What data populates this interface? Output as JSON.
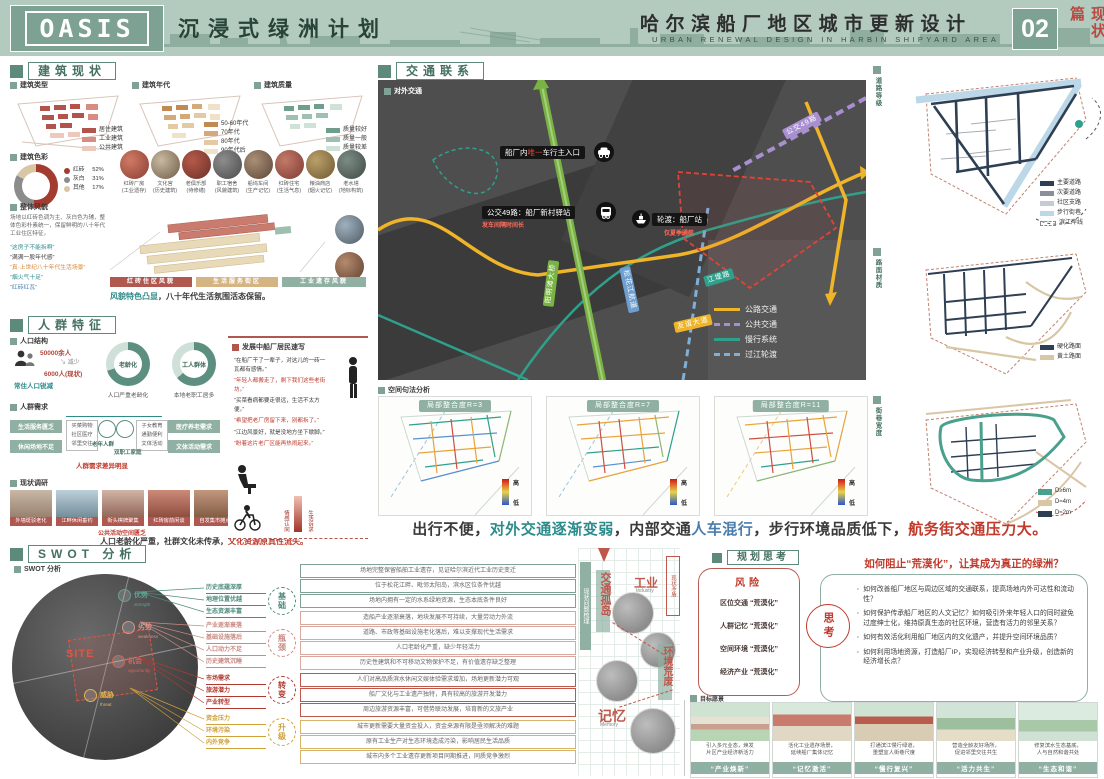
{
  "header": {
    "logo": "OASIS",
    "subtitle": "沉浸式绿洲计划",
    "project_cn": "哈尔滨船厂地区城市更新设计",
    "project_en": "URBAN RENEWAL DESIGN IN HARBIN SHIPYARD AREA",
    "page_no": "02",
    "page_tag": "现状篇"
  },
  "building": {
    "title": "建筑现状",
    "maps": [
      {
        "label": "建筑类型",
        "legend": [
          "居住建筑",
          "工业建筑",
          "公共建筑"
        ]
      },
      {
        "label": "建筑年代",
        "legend": [
          "50-60年代",
          "70年代",
          "80年代",
          "90年代后"
        ]
      },
      {
        "label": "建筑质量",
        "legend": [
          "质量较好",
          "质量一般",
          "质量较差"
        ]
      }
    ],
    "color": {
      "label": "建筑色彩",
      "slices": [
        {
          "name": "红砖",
          "pct": "52%"
        },
        {
          "name": "灰白",
          "pct": "31%"
        },
        {
          "name": "其他",
          "pct": "17%"
        }
      ],
      "note": "场地以红砖色调为主、灰白色为辅，整体色彩朴素统一，保留鲜明的八十年代工业住区特征。"
    },
    "photos": [
      {
        "name": "红砖厂房",
        "note": "(工业遗存)"
      },
      {
        "name": "文化宫",
        "note": "(历史建筑)"
      },
      {
        "name": "老俱乐部",
        "note": "(待修缮)"
      },
      {
        "name": "职工宿舍",
        "note": "(风貌建筑)"
      },
      {
        "name": "船坞车间",
        "note": "(生产记忆)"
      },
      {
        "name": "红砖住宅",
        "note": "(生活气息)"
      },
      {
        "name": "粮油商店",
        "note": "(烟火记忆)"
      },
      {
        "name": "老水塔",
        "note": "(地标构筑)"
      }
    ],
    "axon_tag": "整体风貌",
    "quotes": [
      {
        "t": "“这房子不能拆啊”"
      },
      {
        "t": "“满满一股年代感”"
      },
      {
        "t": "“真·上世纪八十年代生活场景”"
      },
      {
        "t": "“烟火气十足”"
      },
      {
        "t": "“红砖红瓦”"
      }
    ],
    "zones": [
      "红砖住区风貌",
      "生活服务街区",
      "工业遗存风貌"
    ],
    "summary": [
      {
        "t": "风貌特色凸显"
      },
      {
        "t": "，八十年代生活氛围活态保留。"
      }
    ]
  },
  "population": {
    "title": "人群特征",
    "struct": {
      "label": "人口结构",
      "from": "50000余人",
      "trend": "减少",
      "to": "6000人(现状)",
      "cap": "常住人口锐减",
      "donuts": [
        {
          "center": "老龄化",
          "cap": "人口严重老龄化"
        },
        {
          "center": "工人群体",
          "cap": "本地老职工居多"
        }
      ]
    },
    "needs": {
      "label": "人群需求",
      "left": [
        "生活服务匮乏",
        "休闲场地不足"
      ],
      "right": [
        "医疗养老需求",
        "文体活动需求"
      ],
      "g1": "老年人群",
      "g2": "双职工家庭",
      "list1": [
        "买菜购物",
        "社区医疗",
        "邻里交往"
      ],
      "list2": [
        "子女教育",
        "通勤便利",
        "文体活动"
      ],
      "cap": "人群需求差异明显"
    },
    "voice": {
      "label": "发展中船厂居民速写",
      "quotes": [
        {
          "t": "“在船厂干了一辈子，对这儿的一砖一瓦都有感情。”"
        },
        {
          "t": "“年轻人都搬走了，剩下我们这些老街坊。”"
        },
        {
          "t": "“买菜看病都要走很远，生活不太方便。”"
        },
        {
          "t": "“希望把老厂房留下来，别都拆了。”"
        },
        {
          "t": "“江边风景好，就是没地方坐下歇脚。”"
        },
        {
          "t": "“盼着这片老厂区能再热闹起来。”"
        }
      ],
      "bar_hi": "情感认同",
      "bar_lo": "生活诉求"
    }
  },
  "survey": {
    "label": "现状调研",
    "photos": [
      "外墙斑驳老化",
      "江畔休闲垂钓",
      "街头棋牌聚集",
      "红砖房前闲谈",
      "自发集市摊点"
    ],
    "note": "公共活动空间匮乏",
    "summary": [
      {
        "t": "人口老龄化严重，社群文化未传承，"
      },
      {
        "t": "文化资源原真性流失。"
      }
    ]
  },
  "swot": {
    "title": "SWOT 分析",
    "sub": "SWOT 分析",
    "site": "SITE",
    "quads": [
      {
        "cn": "优势",
        "en": "strength"
      },
      {
        "cn": "劣势",
        "en": "weakness"
      },
      {
        "cn": "机会",
        "en": "opportunity"
      },
      {
        "cn": "威胁",
        "en": "threat"
      }
    ],
    "factors": [
      {
        "t": "历史底蕴深厚"
      },
      {
        "t": "地理位置优越"
      },
      {
        "t": "生态资源丰富"
      },
      {
        "t": "产业逐渐衰落"
      },
      {
        "t": "基础设施落后"
      },
      {
        "t": "人口动力不足"
      },
      {
        "t": "历史建筑沉睡"
      },
      {
        "t": "市场需求"
      },
      {
        "t": "旅游潜力"
      },
      {
        "t": "产业转型"
      },
      {
        "t": "资金压力"
      },
      {
        "t": "环境污染"
      },
      {
        "t": "内外竞争"
      }
    ],
    "groups": [
      "基础",
      "瓶颈",
      "转变",
      "升级"
    ],
    "details": [
      {
        "t": "场地完整保留船舶工业遗存，见证哈尔滨近代工业历史变迁"
      },
      {
        "t": "位于松花江畔、毗邻太阳岛，滨水区位条件优越"
      },
      {
        "t": "场地内拥有一定的水系绿地资源，生态本底条件良好"
      },
      {
        "t": "造船产业逐渐衰落，地块发展不可持续，大量劳动力外流"
      },
      {
        "t": "道路、市政等基础设施老化落后，难以支撑现代生活需求"
      },
      {
        "t": "人口老龄化严重，缺少年轻活力"
      },
      {
        "t": "历史性建筑和不可移动文物保护不足，有价值遗存缺乏整理"
      },
      {
        "t": "人们对高品质滨水休闲文娱体验需求增加，场地更新潜力可观"
      },
      {
        "t": "船厂文化与工业遗产独特，具有较高的旅游开发潜力"
      },
      {
        "t": "周边旅游资源丰富，可借势联动发展，培育新的文旅产业"
      },
      {
        "t": "城市更新需要大量资金投入，资金来源有限是亟须解决的难题"
      },
      {
        "t": "原有工业生产对生态环境造成污染，影响居民生活品质"
      },
      {
        "t": "城市内多个工业遗存更新项目同期推进，同质竞争激烈"
      }
    ]
  },
  "traffic": {
    "title": "交通联系",
    "map_tag": "对外交通",
    "entrance": {
      "pre": "船厂内",
      "hl": "唯一",
      "post": "车行主入口"
    },
    "bus": {
      "t": "公交49路：船厂新村驿站",
      "note": "发车间隔时间长"
    },
    "ferry": {
      "t": "轮渡：船厂站",
      "note": "仅夏季通航"
    },
    "roads": {
      "green": "阳明滩大桥",
      "yellow": "友谊大道",
      "teal": "江堤路",
      "blue": "松花江航道",
      "purple": "公交49路"
    },
    "legend": [
      "公路交通",
      "公共交通",
      "慢行系统",
      "过江轮渡"
    ]
  },
  "syntax": {
    "label": "空间句法分析",
    "maps": [
      "局部整合度R=3",
      "局部整合度R=7",
      "局部整合度R=11"
    ],
    "hi": "高",
    "lo": "低"
  },
  "conclusion": {
    "parts": [
      {
        "t": "出行不便，"
      },
      {
        "t": "对外交通逐渐变弱"
      },
      {
        "t": "，内部交通"
      },
      {
        "t": "人车混行"
      },
      {
        "t": "，步行环境品质低下，"
      },
      {
        "t": "航务街交通压力大。"
      }
    ]
  },
  "rightmaps": {
    "maps": [
      {
        "tag": "道路等级",
        "legend": [
          {
            "t": "主要道路"
          },
          {
            "t": "次要道路"
          },
          {
            "t": "社区支路"
          },
          {
            "t": "步行街巷"
          },
          {
            "t": "滨江岸线"
          }
        ]
      },
      {
        "tag": "路面材质",
        "legend": [
          {
            "t": "硬化路面"
          },
          {
            "t": "黄土路面"
          }
        ]
      },
      {
        "tag": "街巷宽度",
        "legend": [
          {
            "t": "D≥6m"
          },
          {
            "t": "D≈4m"
          },
          {
            "t": "D≈2m"
          }
        ]
      }
    ]
  },
  "planning": {
    "title": "规划思考",
    "diagram": {
      "tag": "现状问题梳理",
      "note": "现状矛盾",
      "k1": "交通孤岛",
      "k2": "工业",
      "k2en": "Industry",
      "k3": "环境荒废",
      "k4": "记忆",
      "k4en": "Memory"
    },
    "risk": {
      "title": "风险",
      "items": [
        "区位交通 “荒漠化”",
        "人群记忆 “荒漠化”",
        "空间环境 “荒漠化”",
        "经济产业 “荒漠化”"
      ]
    },
    "think": "思考",
    "q_title": "如何阻止“荒漠化”，让其成为真正的绿洲？",
    "questions": [
      "如何改善船厂地区与周边区域的交通联系，提高场地内外可达性和流动性？",
      "如何保护传承船厂地区的人文记忆？如何吸引外来年轻人口的同时避免过度绅士化，维持原真生态的社区环境，营造有活力的邻里关系？",
      "如何有效活化利用船厂地区内的文化遗产，并提升空间环境品质？",
      "如何利用场地资源，打造船厂IP，实现经济转型和产业升级，创造新的经济增长点？"
    ],
    "vision_tag": "目标愿景",
    "cards": [
      {
        "cap1": "引入多元业态，焕发",
        "cap2": "片区产业经济新活力",
        "tag": "“产业焕新”"
      },
      {
        "cap1": "活化工业遗存场景，",
        "cap2": "延续船厂集体记忆",
        "tag": "“记忆激活”"
      },
      {
        "cap1": "打通滨江慢行绿道，",
        "cap2": "重塑宜人街巷尺度",
        "tag": "“慢行复兴”"
      },
      {
        "cap1": "营造全龄友好场所，",
        "cap2": "促进邻里交往共生",
        "tag": "“活力共生”"
      },
      {
        "cap1": "修复滨水生态基底，",
        "cap2": "人与自然和谐共处",
        "tag": "“生态和谐”"
      }
    ]
  }
}
